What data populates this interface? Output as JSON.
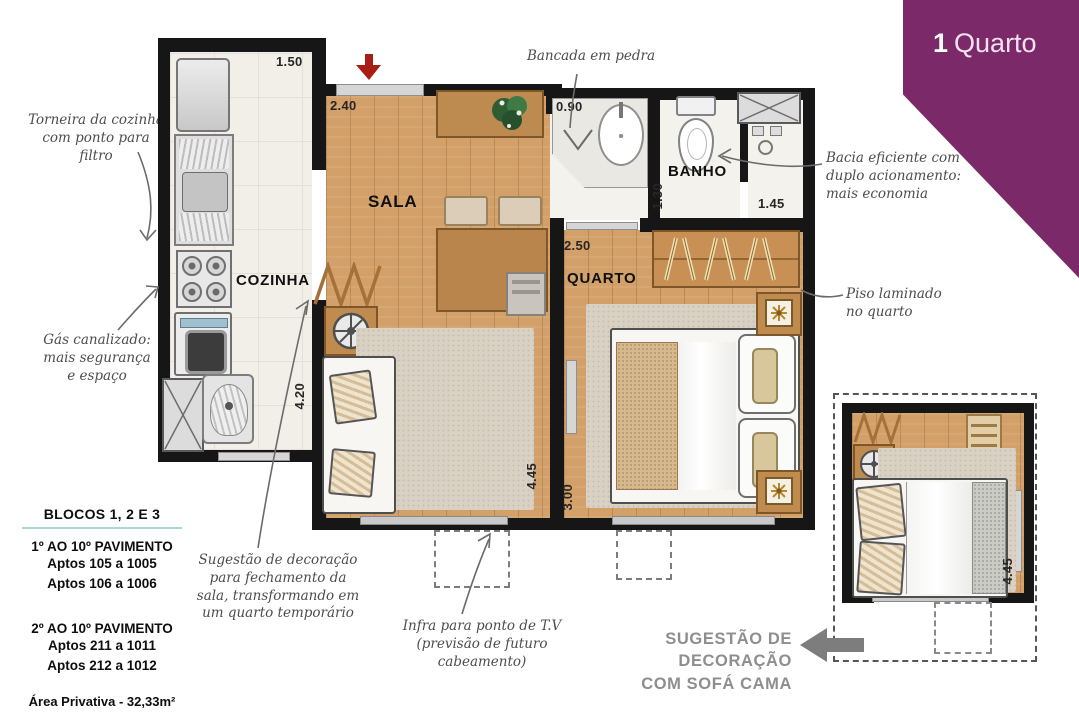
{
  "banner": {
    "number": "1",
    "title": "Quarto"
  },
  "plan": {
    "rooms": {
      "sala": "SALA",
      "cozinha": "COZINHA",
      "quarto": "QUARTO",
      "banho": "BANHO"
    },
    "dims": {
      "kitchen_width": "1.50",
      "kitchen_length": "4.20",
      "sala_width": "2.40",
      "sala_length": "4.45",
      "counter": "0.90",
      "banho_width": "1.30",
      "shower_width": "1.45",
      "quarto_width": "2.50",
      "quarto_length": "3.00",
      "inset_length": "4.45"
    }
  },
  "annotations": {
    "torneira": "Torneira da cozinha\ncom ponto para filtro",
    "gas": "Gás canalizado:\nmais segurança\ne espaço",
    "bancada": "Bancada em pedra",
    "bacia": "Bacia eficiente com\nduplo acionamento:\nmais economia",
    "piso": "Piso laminado\nno quarto",
    "fechamento": "Sugestão de decoração\npara fechamento da\nsala, transformando em\num quarto temporário",
    "infra": "Infra para ponto de T.V\n(previsão de futuro\ncabeamento)",
    "sofa_cama": "SUGESTÃO DE DECORAÇÃO\nCOM SOFÁ CAMA"
  },
  "info": {
    "title": "BLOCOS 1, 2 E 3",
    "sections": [
      {
        "heading": "1º AO 10º  PAVIMENTO",
        "lines": [
          "Aptos 105 a 1005",
          "Aptos 106 a 1006"
        ]
      },
      {
        "heading": "2º AO 10º PAVIMENTO",
        "lines": [
          "Aptos 211 a 1011",
          "Aptos 212 a 1012"
        ]
      }
    ],
    "area": "Área Privativa - 32,33m²"
  },
  "colors": {
    "banner_purple": "#7b2968",
    "wood": "#d2a068",
    "teal_rule": "#a8d8d4",
    "entry_arrow_red": "#aa1d12",
    "caption_gray": "#8e8e8e",
    "wall_black": "#161616"
  }
}
